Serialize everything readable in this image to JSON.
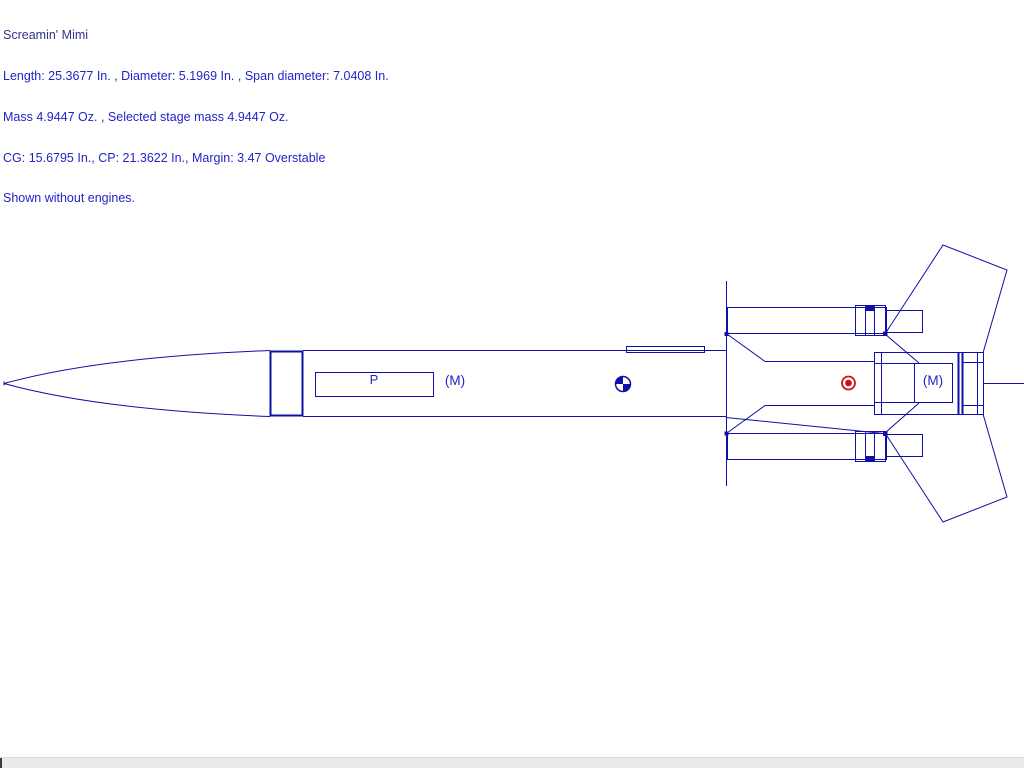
{
  "header": {
    "title": "Screamin' Mimi",
    "info_lines": [
      "Length: 25.3677 In. , Diameter: 5.1969 In. , Span diameter: 7.0408 In.",
      "Mass 4.9447 Oz. , Selected stage mass 4.9447 Oz.",
      "CG: 15.6795 In., CP: 21.3622 In., Margin: 3.47 Overstable",
      "Shown without engines."
    ]
  },
  "diagram": {
    "parachute_label": "P",
    "mass_label_fore": "(M)",
    "mass_label_aft": "(M)",
    "cg_value_in": "15.6795",
    "cp_value_in": "21.3622"
  },
  "colors": {
    "outline_blue": "#0f0fa8",
    "label_blue": "#2323c8",
    "title_navy": "#333388",
    "cp_red": "#cc1111",
    "background": "#ffffff",
    "bottom_strip": "#ebebeb"
  }
}
